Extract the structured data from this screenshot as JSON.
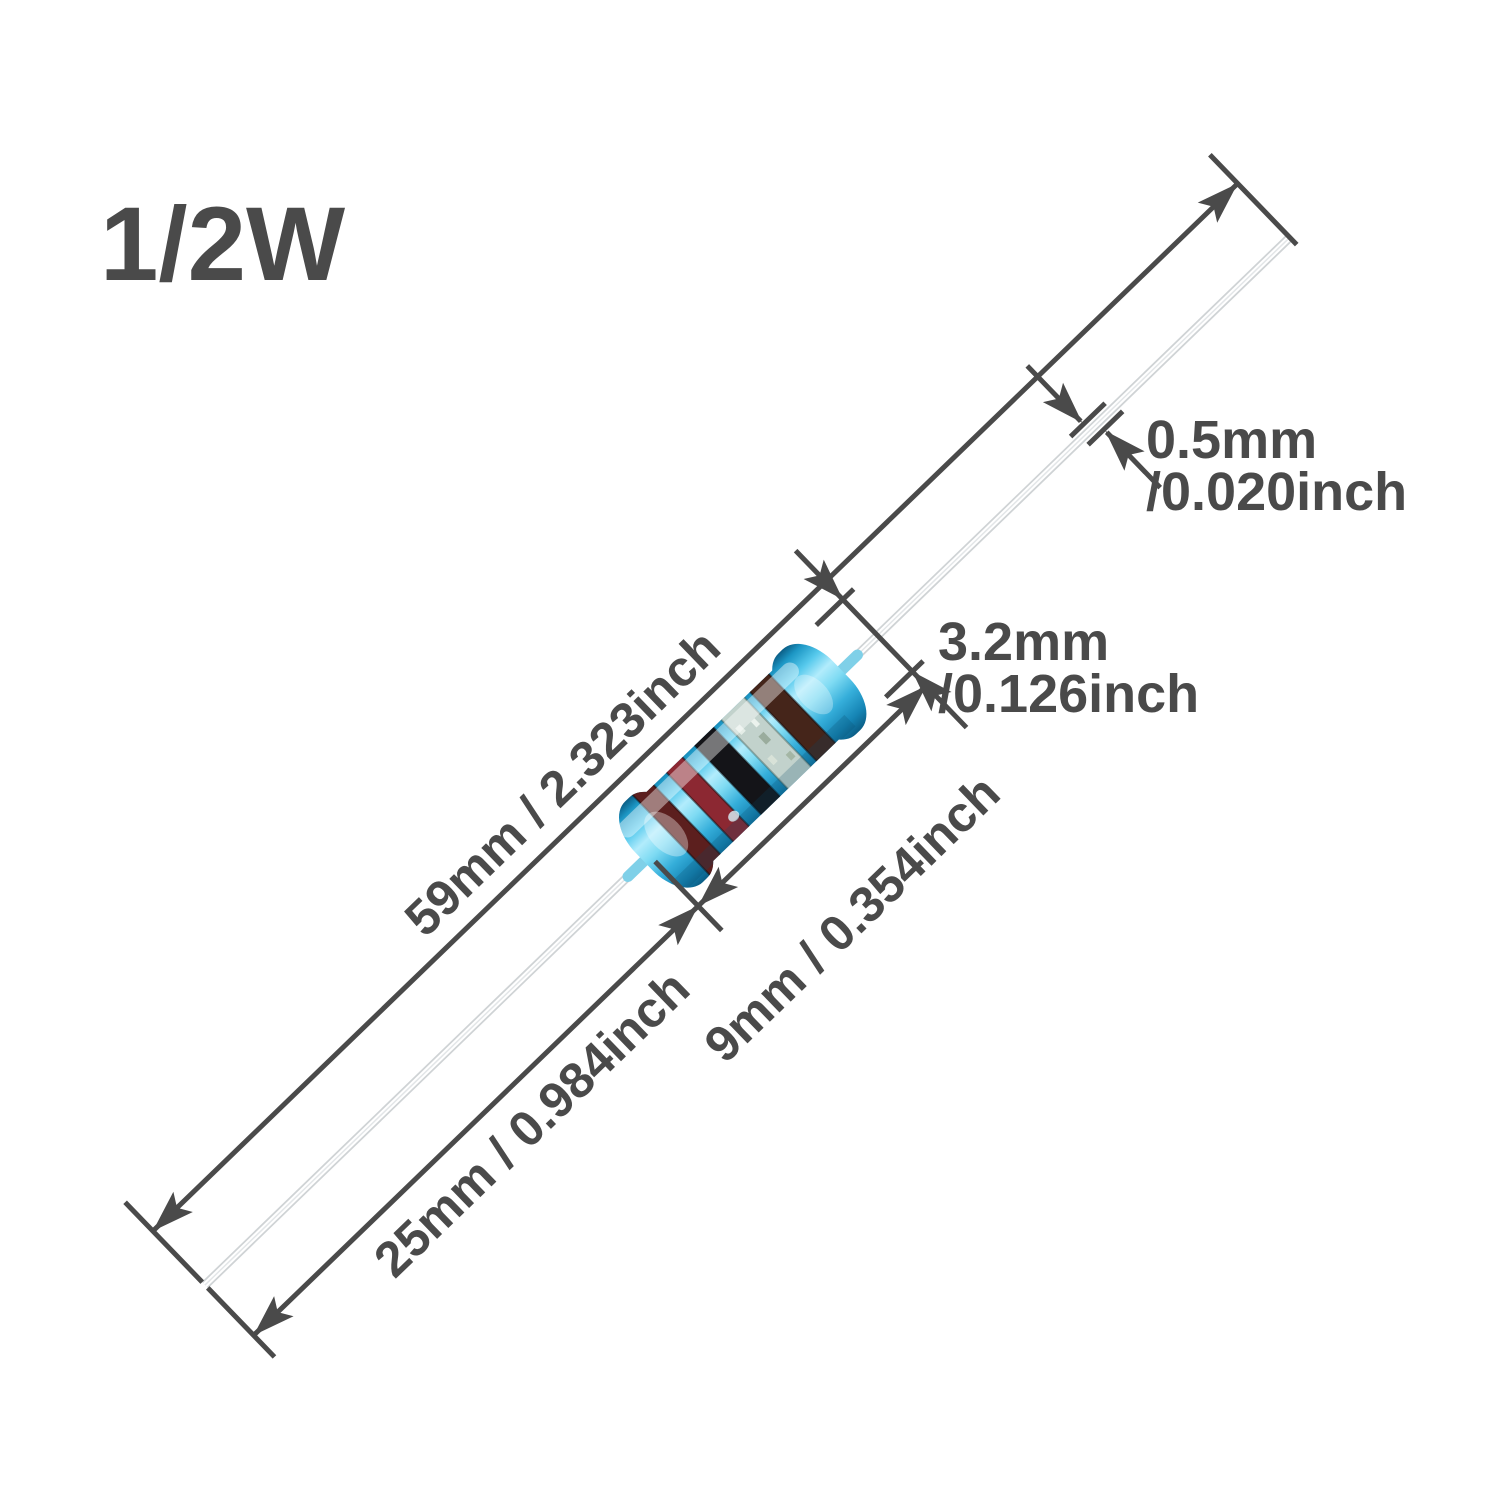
{
  "header": {
    "wattage_label": "1/2W"
  },
  "callouts": {
    "total_length_label": "59mm / 2.323inch",
    "lead_length_label": "25mm / 0.984inch",
    "body_length_label": "9mm / 0.354inch",
    "body_diameter_mm": "3.2mm",
    "body_diameter_inch": "/0.126inch",
    "lead_diameter_mm": "0.5mm",
    "lead_diameter_inch": "/0.020inch"
  },
  "component": {
    "type": "metal film resistor",
    "orientation": "diagonal lower-left to upper-right",
    "body_color": "#35b2e0",
    "body_highlight_color": "#b2ecfc",
    "body_shadow_color": "#0b5e86",
    "lead_color": "#ffffff",
    "lead_edge_color": "#cfd3d5",
    "bands": [
      {
        "name": "band-1-maroon",
        "color": "#5c1f1e"
      },
      {
        "name": "band-2-red",
        "color": "#8c2832"
      },
      {
        "name": "band-3-black",
        "color": "#141418"
      },
      {
        "name": "band-4-silver",
        "color": "#c2d2cc"
      },
      {
        "name": "band-5-brown",
        "color": "#45251a"
      }
    ]
  },
  "style": {
    "dimension_color": "#4a4a4a",
    "background_color": "#ffffff"
  }
}
